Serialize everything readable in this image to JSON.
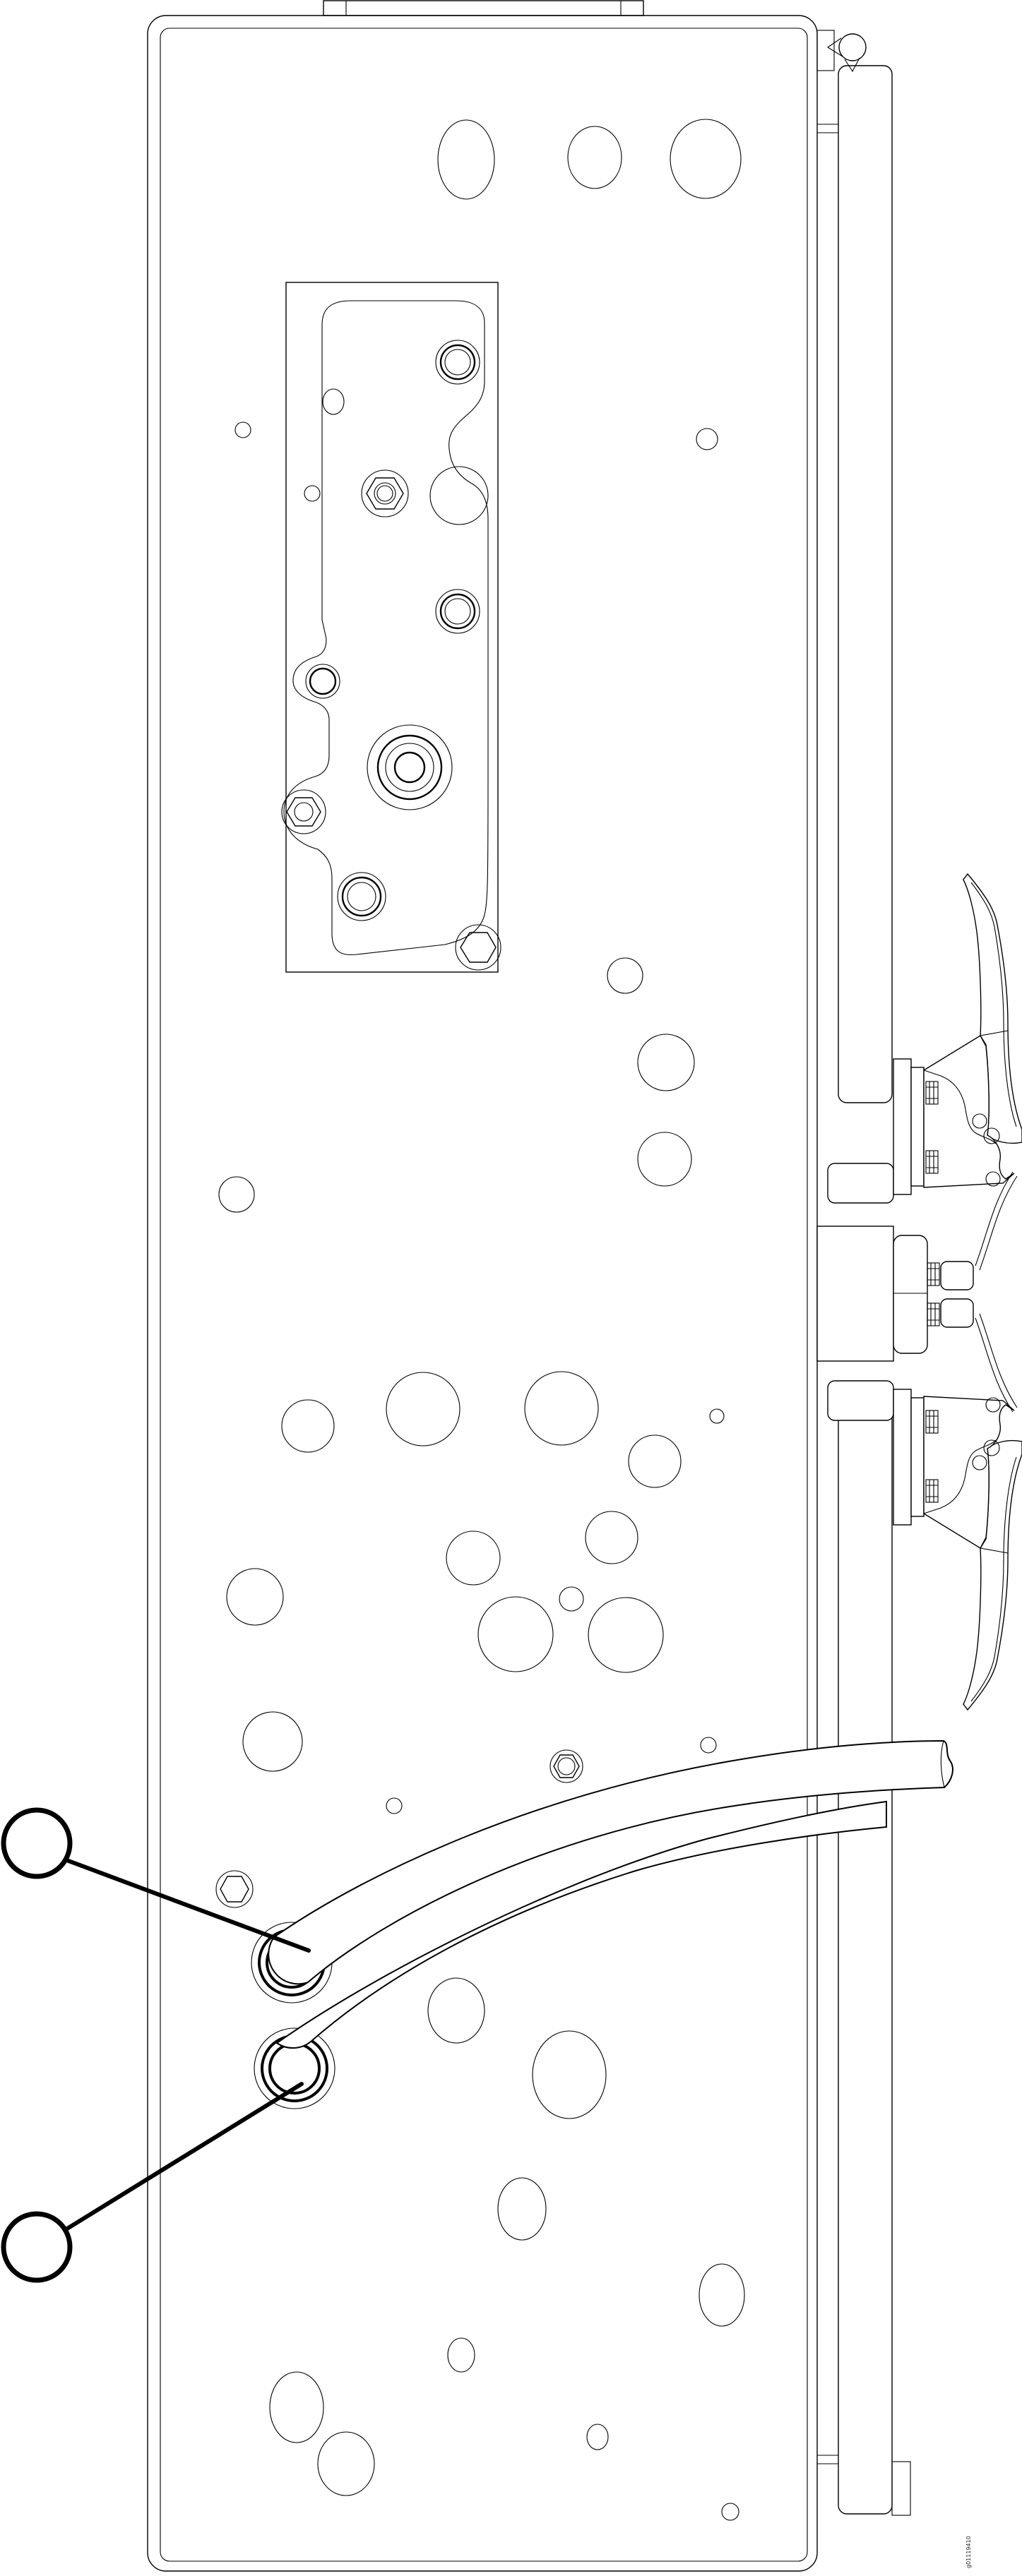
{
  "figure": {
    "id": "g01119410"
  },
  "callouts": [
    {
      "index": 1,
      "label": ""
    },
    {
      "index": 2,
      "label": ""
    }
  ],
  "colors": {
    "line": "#000000",
    "background": "#ffffff"
  }
}
